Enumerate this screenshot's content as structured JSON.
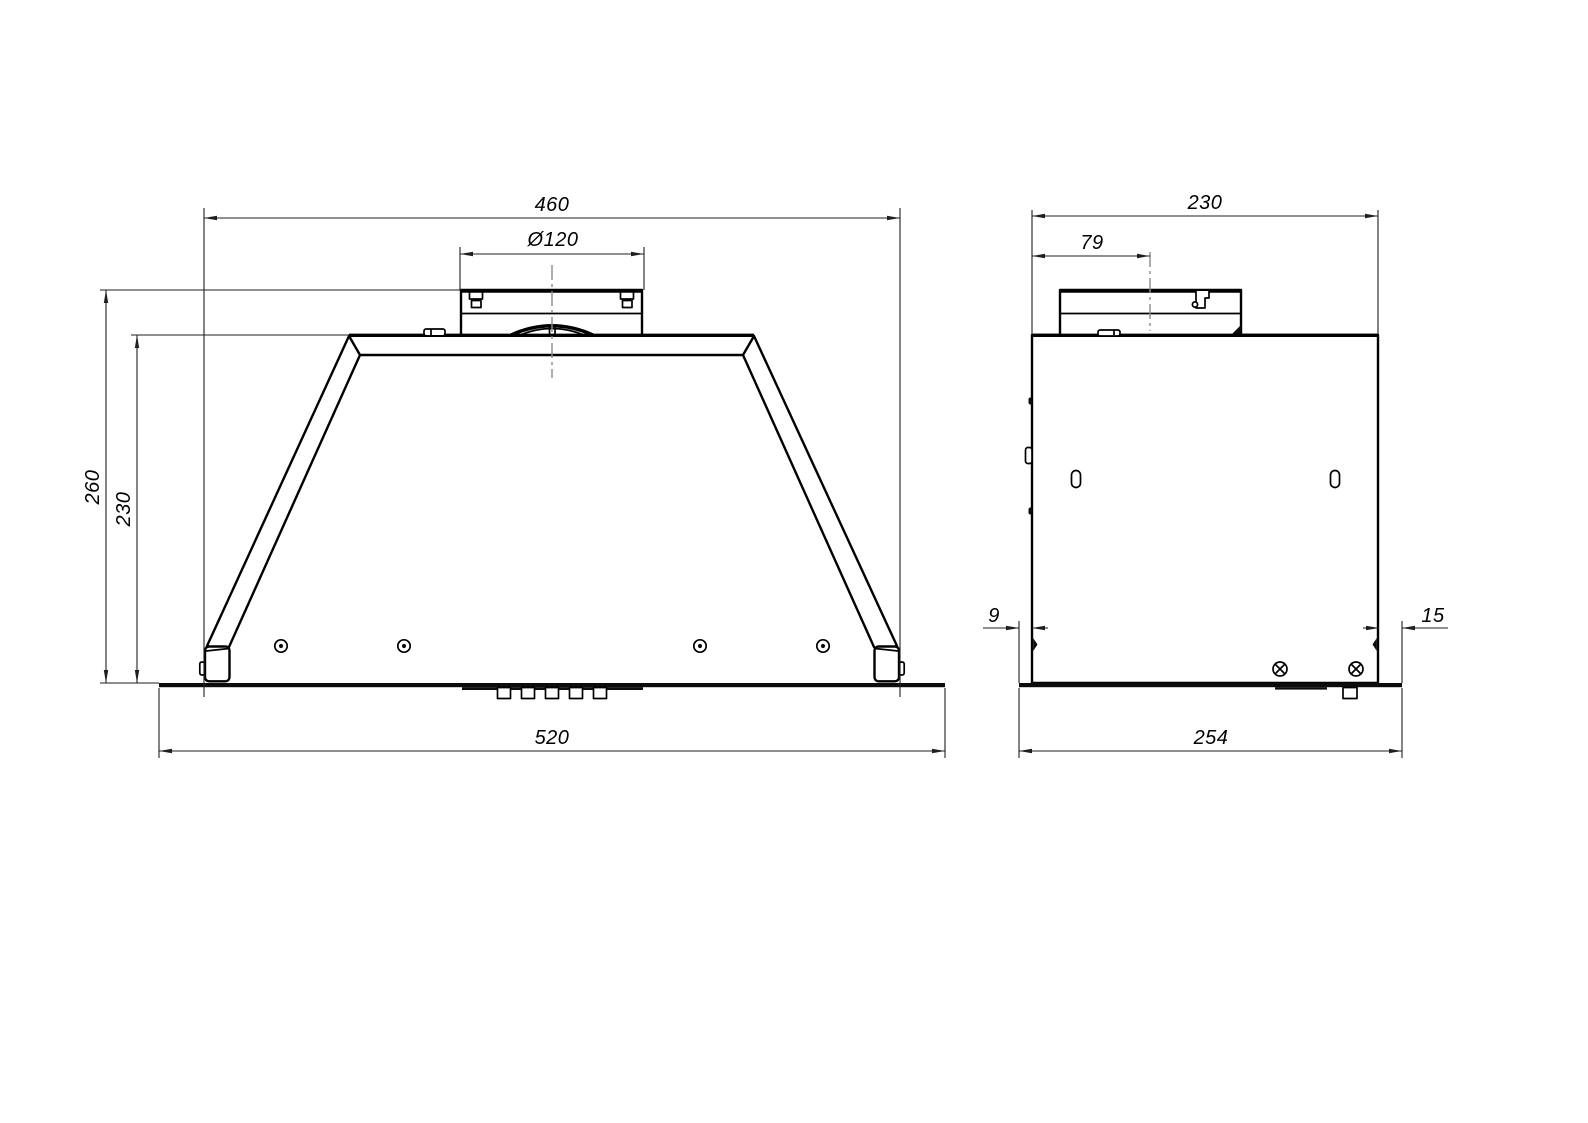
{
  "drawing": {
    "background_color": "#ffffff",
    "outline_color": "#000000",
    "dimension_color": "#1f1f1f",
    "centerline_color": "#8a8a8a",
    "views": {
      "front": {
        "label": "front-view-of-built-in-hood",
        "dimensions": {
          "body_width": "460",
          "duct_diameter": "Ø120",
          "total_height": "260",
          "body_height": "230",
          "bottom_plate_width": "520"
        }
      },
      "side": {
        "label": "side-view-of-built-in-hood",
        "dimensions": {
          "body_depth": "230",
          "duct_center_offset": "79",
          "plate_front_offset": "9",
          "plate_rear_offset": "15",
          "bottom_plate_depth": "254"
        }
      }
    }
  }
}
